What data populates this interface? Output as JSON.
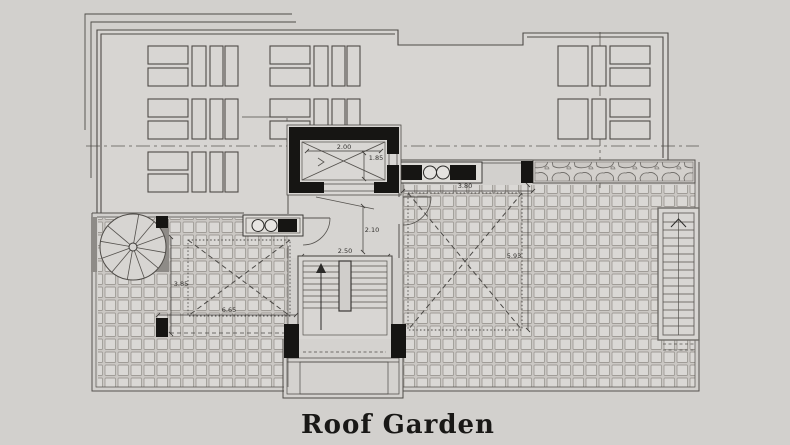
{
  "title": "Roof Garden",
  "dimensions": {
    "elevator_width": "2.00",
    "elevator_depth": "1.85",
    "lobby_door": "2.10",
    "stair_width": "2.50",
    "skylight_right_width": "3.80",
    "skylight_right_length": "5.93",
    "skylight_left_width": "3.85",
    "skylight_left_length": "6.65"
  },
  "colors": {
    "background": "#d2d0cd",
    "wall_line": "#55524e",
    "structure_black": "#161513",
    "tile_line": "#a09c97"
  }
}
